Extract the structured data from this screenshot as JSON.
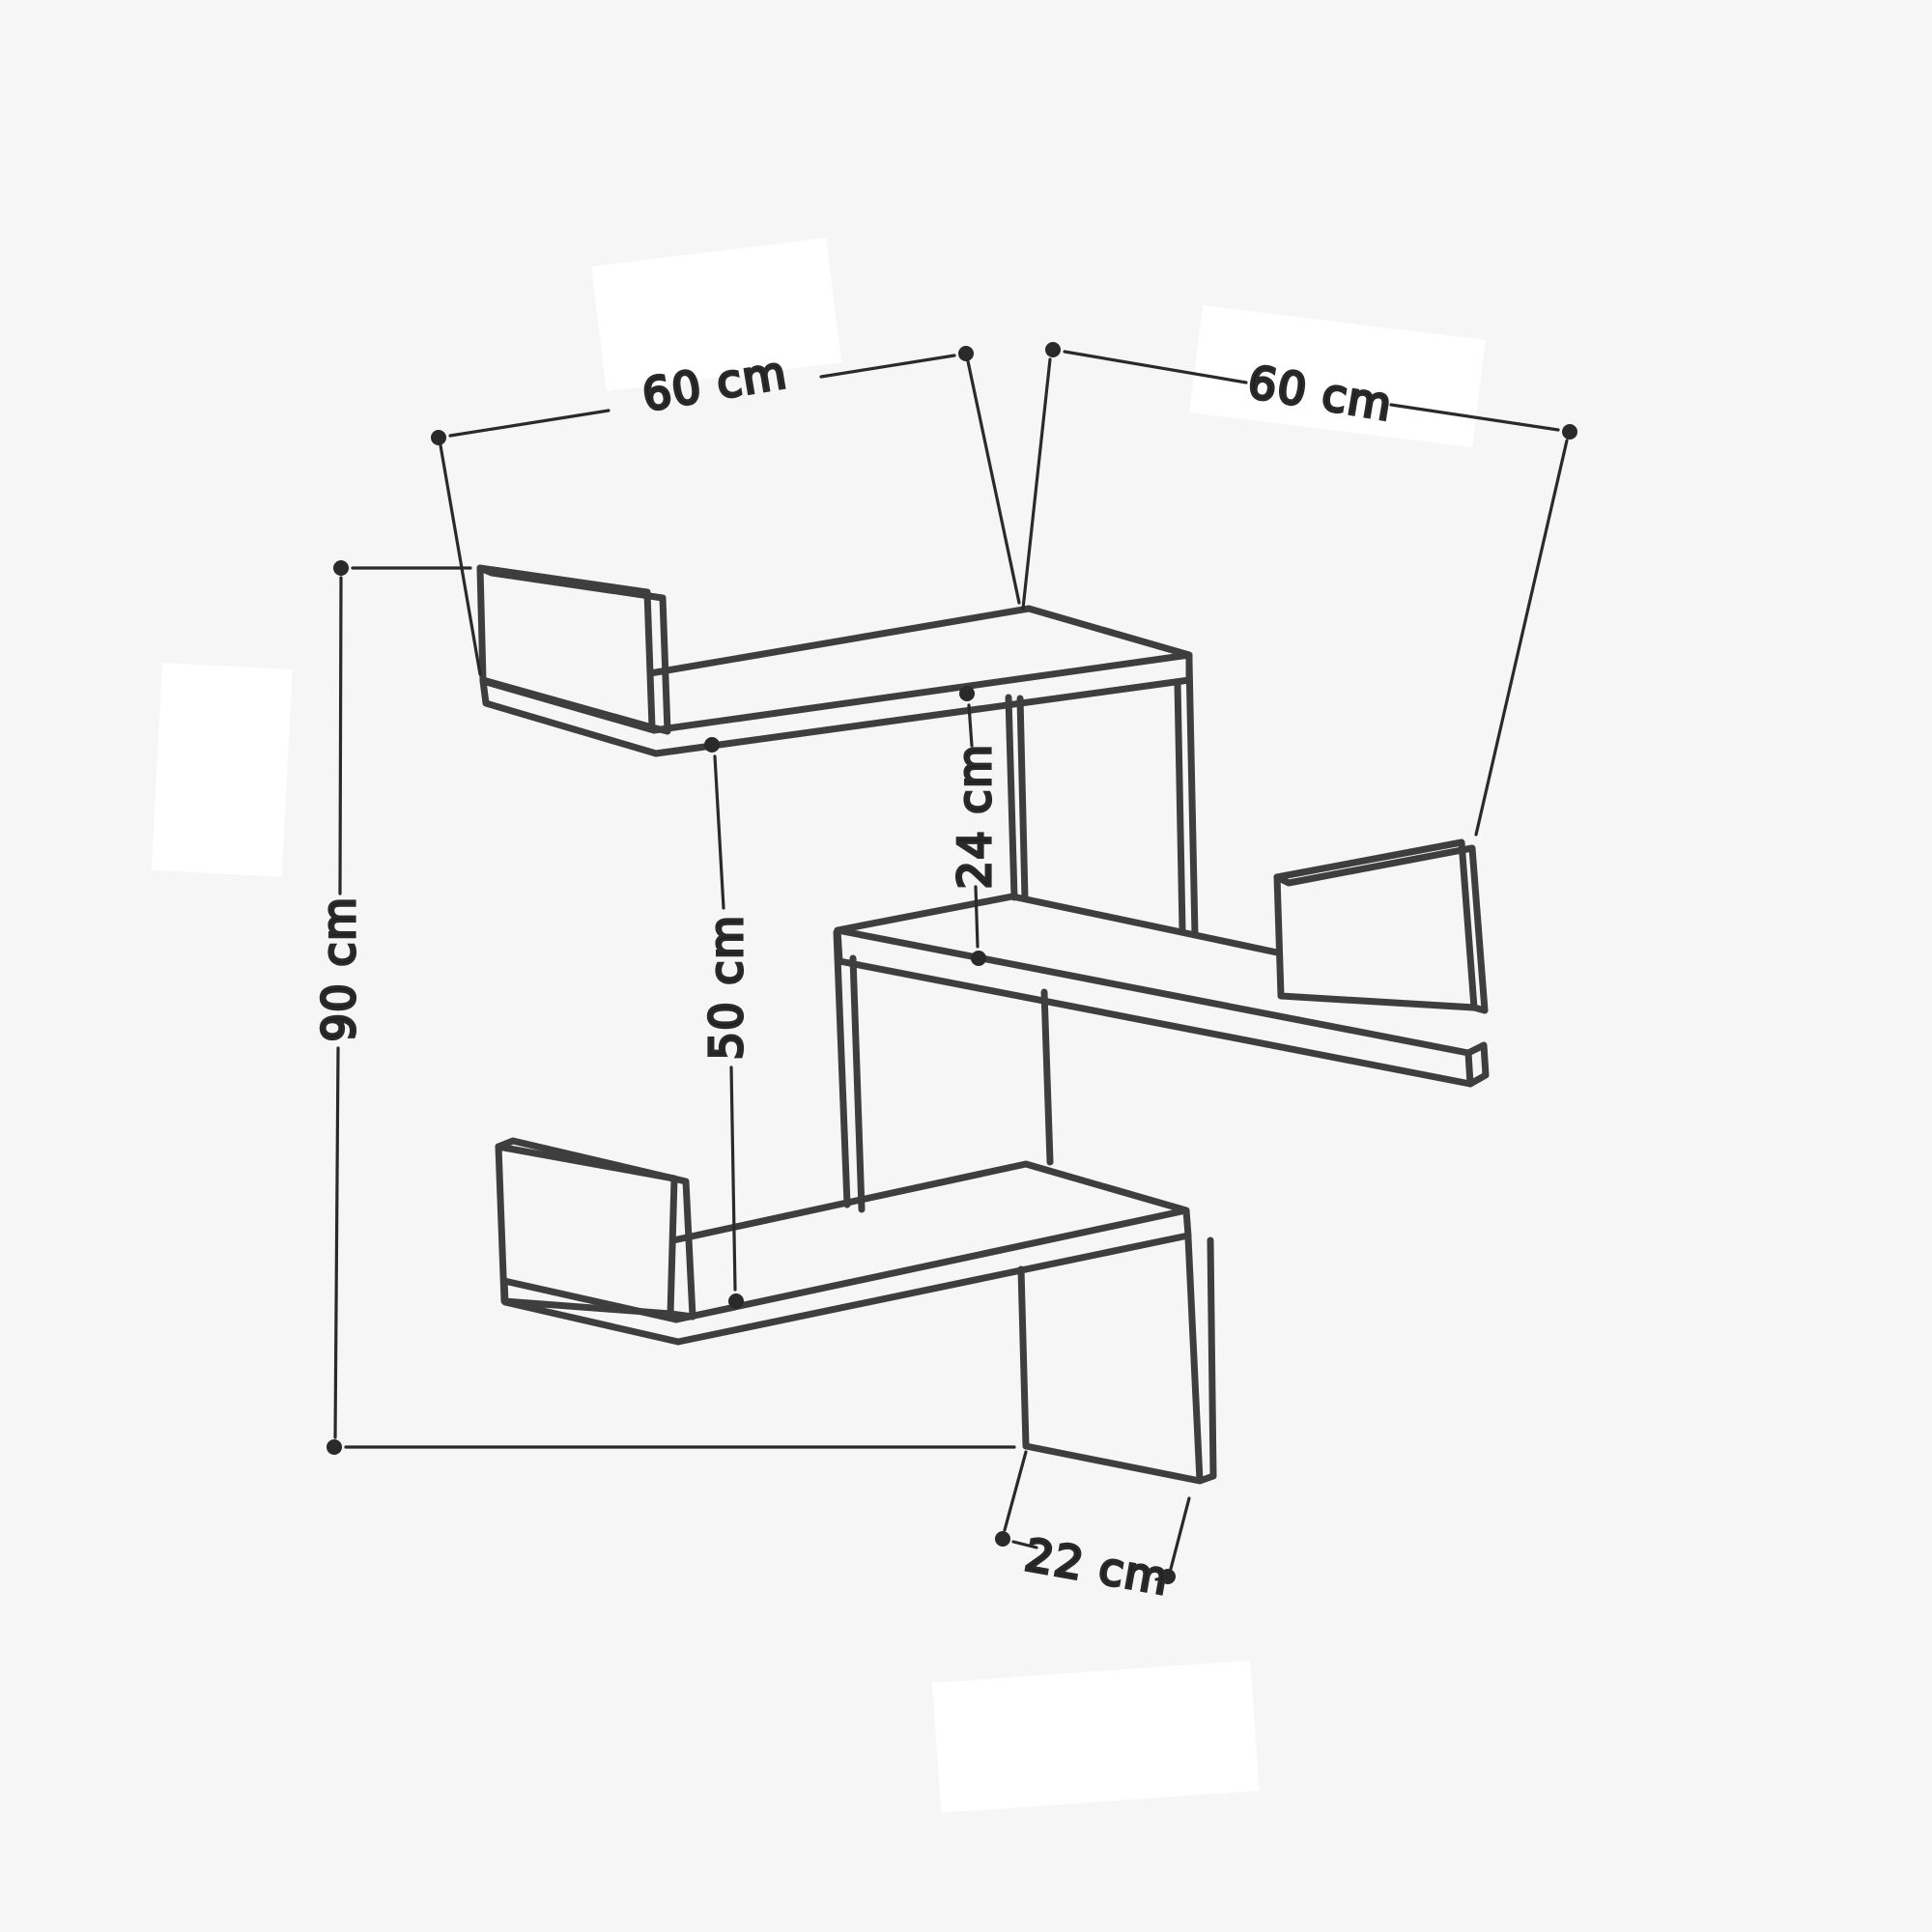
{
  "diagram": {
    "type": "furniture-dimension-line-drawing",
    "subject": "three-tier zigzag corner wall shelf",
    "background_color": "#f6f6f6",
    "line_color": "#3e3e3e",
    "dimension_color": "#2a2a2a",
    "text_color": "#1b1b1b",
    "dimensions": {
      "top_left_width": {
        "label": "60 cm",
        "value": 60,
        "unit": "cm",
        "measures": "width of upper left shelf wing"
      },
      "top_right_width": {
        "label": "60 cm",
        "value": 60,
        "unit": "cm",
        "measures": "width of upper right shelf wing"
      },
      "total_height": {
        "label": "90 cm",
        "value": 90,
        "unit": "cm",
        "measures": "overall height of the unit"
      },
      "large_gap": {
        "label": "50 cm",
        "value": 50,
        "unit": "cm",
        "measures": "spacing between top shelf and bottom shelf"
      },
      "small_gap": {
        "label": "24 cm",
        "value": 24,
        "unit": "cm",
        "measures": "spacing between top shelf and middle shelf"
      },
      "depth": {
        "label": "22 cm",
        "value": 22,
        "unit": "cm",
        "measures": "shelf depth at the bottom support panel"
      }
    }
  }
}
